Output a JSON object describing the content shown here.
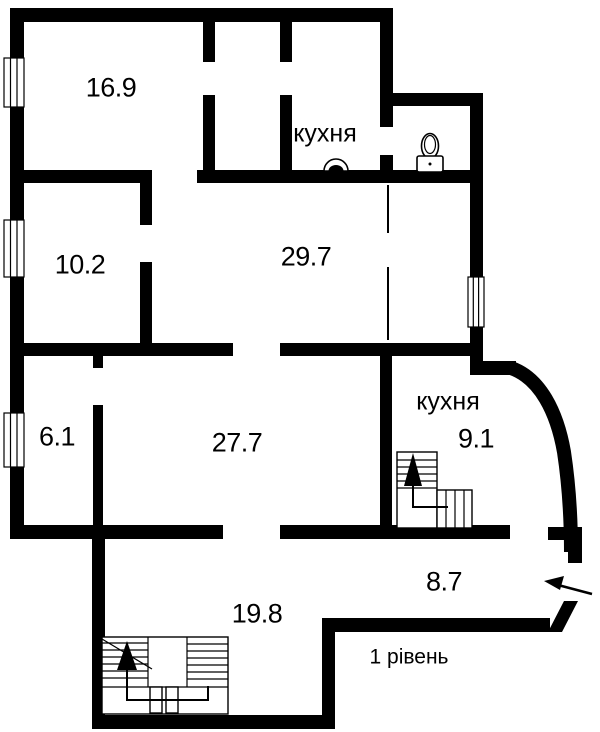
{
  "plan": {
    "level_label": "1 рівень",
    "rooms": [
      {
        "key": "room-top-left",
        "area": "16.9"
      },
      {
        "key": "room-mid-left",
        "area": "10.2"
      },
      {
        "key": "room-mid-center",
        "area": "29.7"
      },
      {
        "key": "room-low-left",
        "area": "6.1"
      },
      {
        "key": "room-low-center",
        "area": "27.7"
      },
      {
        "key": "kitchen-upper",
        "label": "кухня"
      },
      {
        "key": "kitchen-lower",
        "label": "кухня",
        "area": "9.1"
      },
      {
        "key": "corridor-entry",
        "area": "8.7"
      },
      {
        "key": "room-bottom",
        "area": "19.8"
      }
    ],
    "icons": [
      "toilet-icon",
      "sink-icon",
      "stairs-up-main",
      "stairs-up-kitchen",
      "entrance-arrow-icon",
      "window-icon"
    ],
    "colors": {
      "wall": "#000000",
      "background": "#ffffff",
      "text": "#000000"
    }
  }
}
